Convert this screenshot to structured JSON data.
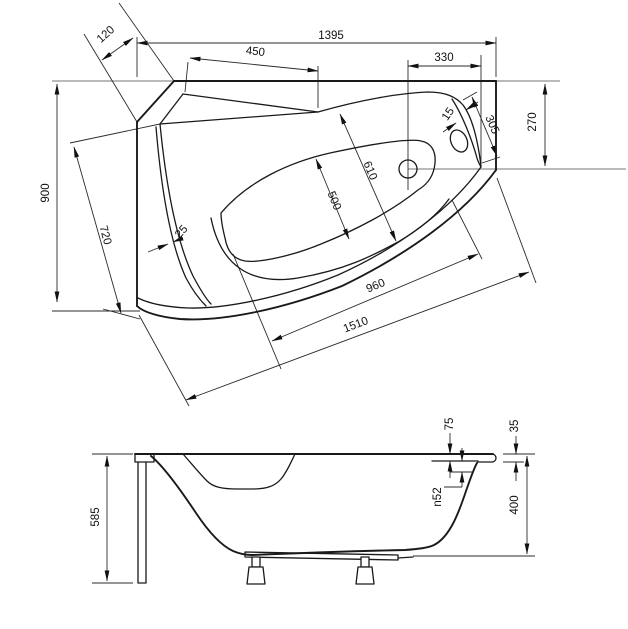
{
  "dimensions": {
    "top_view": {
      "overall_length": "1395",
      "corner_cut": "120",
      "headrest_edge": "450",
      "drain_to_edge": "330",
      "overall_width": "900",
      "inner_width": "720",
      "rim_edge_width": "25",
      "basin_width_top": "610",
      "basin_width_bottom": "500",
      "basin_length_bottom": "960",
      "front_edge_length": "1510",
      "end_width": "270",
      "seat_edge_length": "305",
      "seat_rim_width": "15"
    },
    "side_view": {
      "total_height": "585",
      "overflow_offset": "75",
      "rim_thickness": "35",
      "shell_depth": "400",
      "overflow_diameter": "n52"
    }
  },
  "colors": {
    "line": "#1a1a1a",
    "wall_line": "#a3a3a3",
    "background": "#ffffff"
  }
}
